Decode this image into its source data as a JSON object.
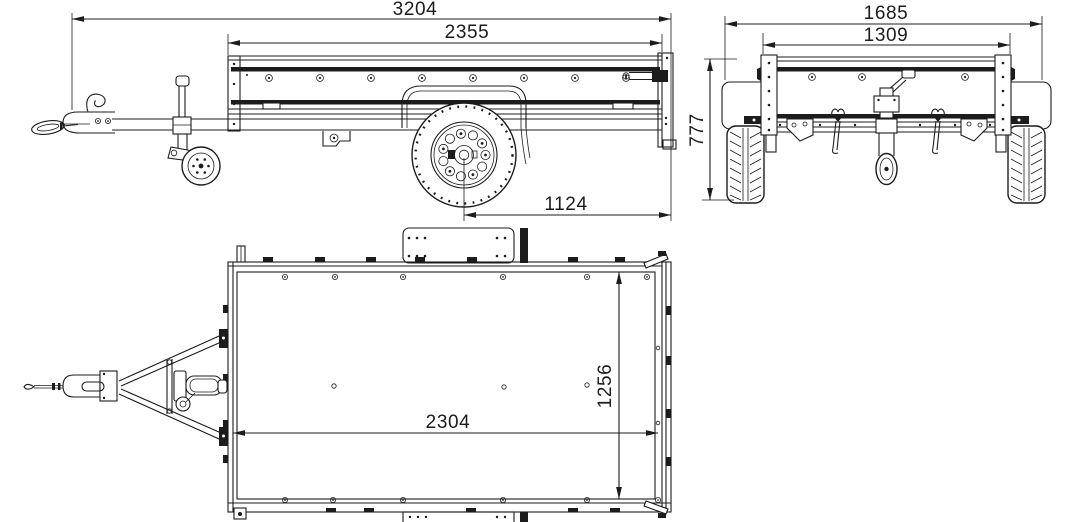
{
  "drawing": {
    "background_color": "#ffffff",
    "line_color": "#1c1c1c",
    "views": {
      "side": {
        "dimensions": {
          "overall_length": "3204",
          "box_length": "2355",
          "axle_to_rear": "1124"
        }
      },
      "rear": {
        "dimensions": {
          "overall_width": "1685",
          "box_width": "1309",
          "overall_height": "777"
        }
      },
      "top": {
        "dimensions": {
          "inner_length": "2304",
          "inner_width": "1256"
        }
      }
    }
  }
}
